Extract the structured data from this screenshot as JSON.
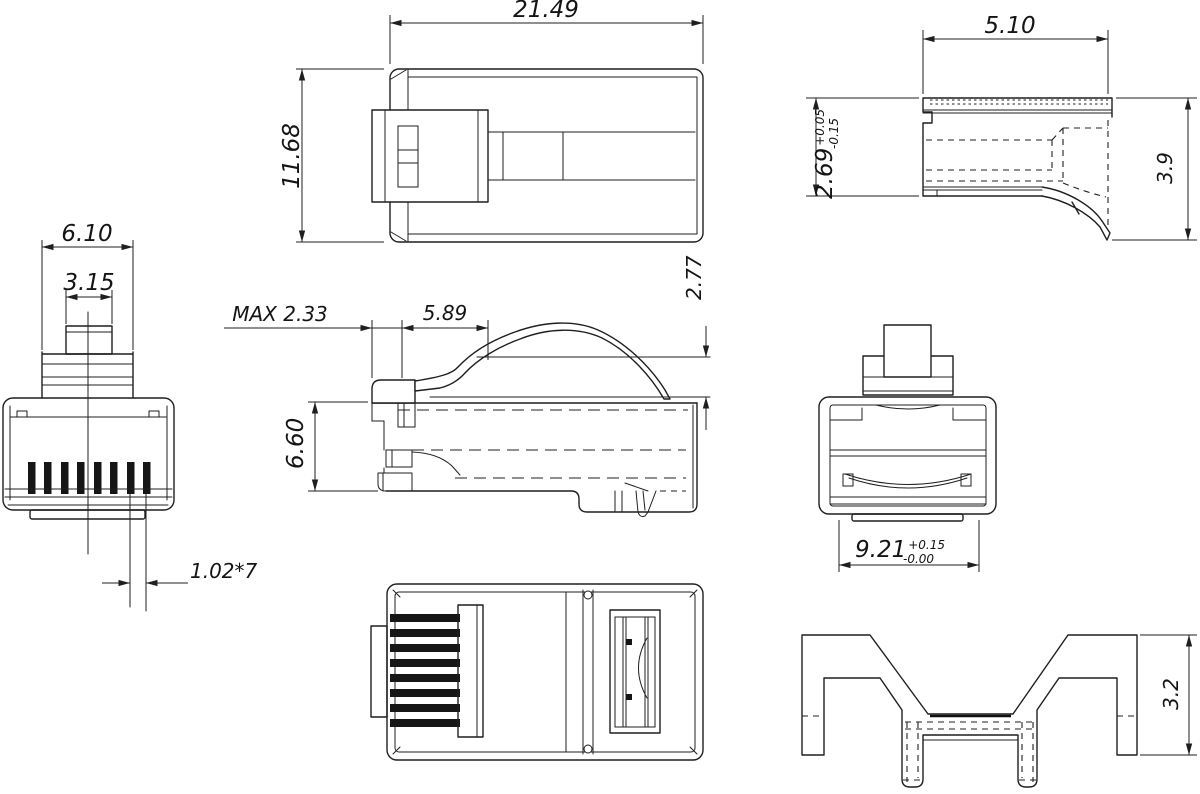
{
  "drawing": {
    "type": "engineering-orthographic-views",
    "subject": "RJ45 modular plug connector",
    "background_color": "#ffffff",
    "line_color": "#1f1f1f",
    "dims": {
      "front": {
        "stem_width": "6.10",
        "tab_width": "3.15",
        "pin_pitch": "1.02*7"
      },
      "top": {
        "length": "21.49",
        "width": "11.68"
      },
      "latch_detail": {
        "length": "5.10",
        "height": "2.69",
        "height_tol_plus": "+0.05",
        "height_tol_minus": "-0.15",
        "overall_height": "3.9"
      },
      "side": {
        "latch_front_max": "MAX 2.33",
        "latch_length": "5.89",
        "lever_rise": "2.77",
        "body_height": "6.60"
      },
      "rear": {
        "cavity_width": "9.21",
        "cavity_tol_plus": "+0.15",
        "cavity_tol_minus": "-0.00"
      },
      "strain_relief": {
        "height": "3.2"
      }
    }
  }
}
